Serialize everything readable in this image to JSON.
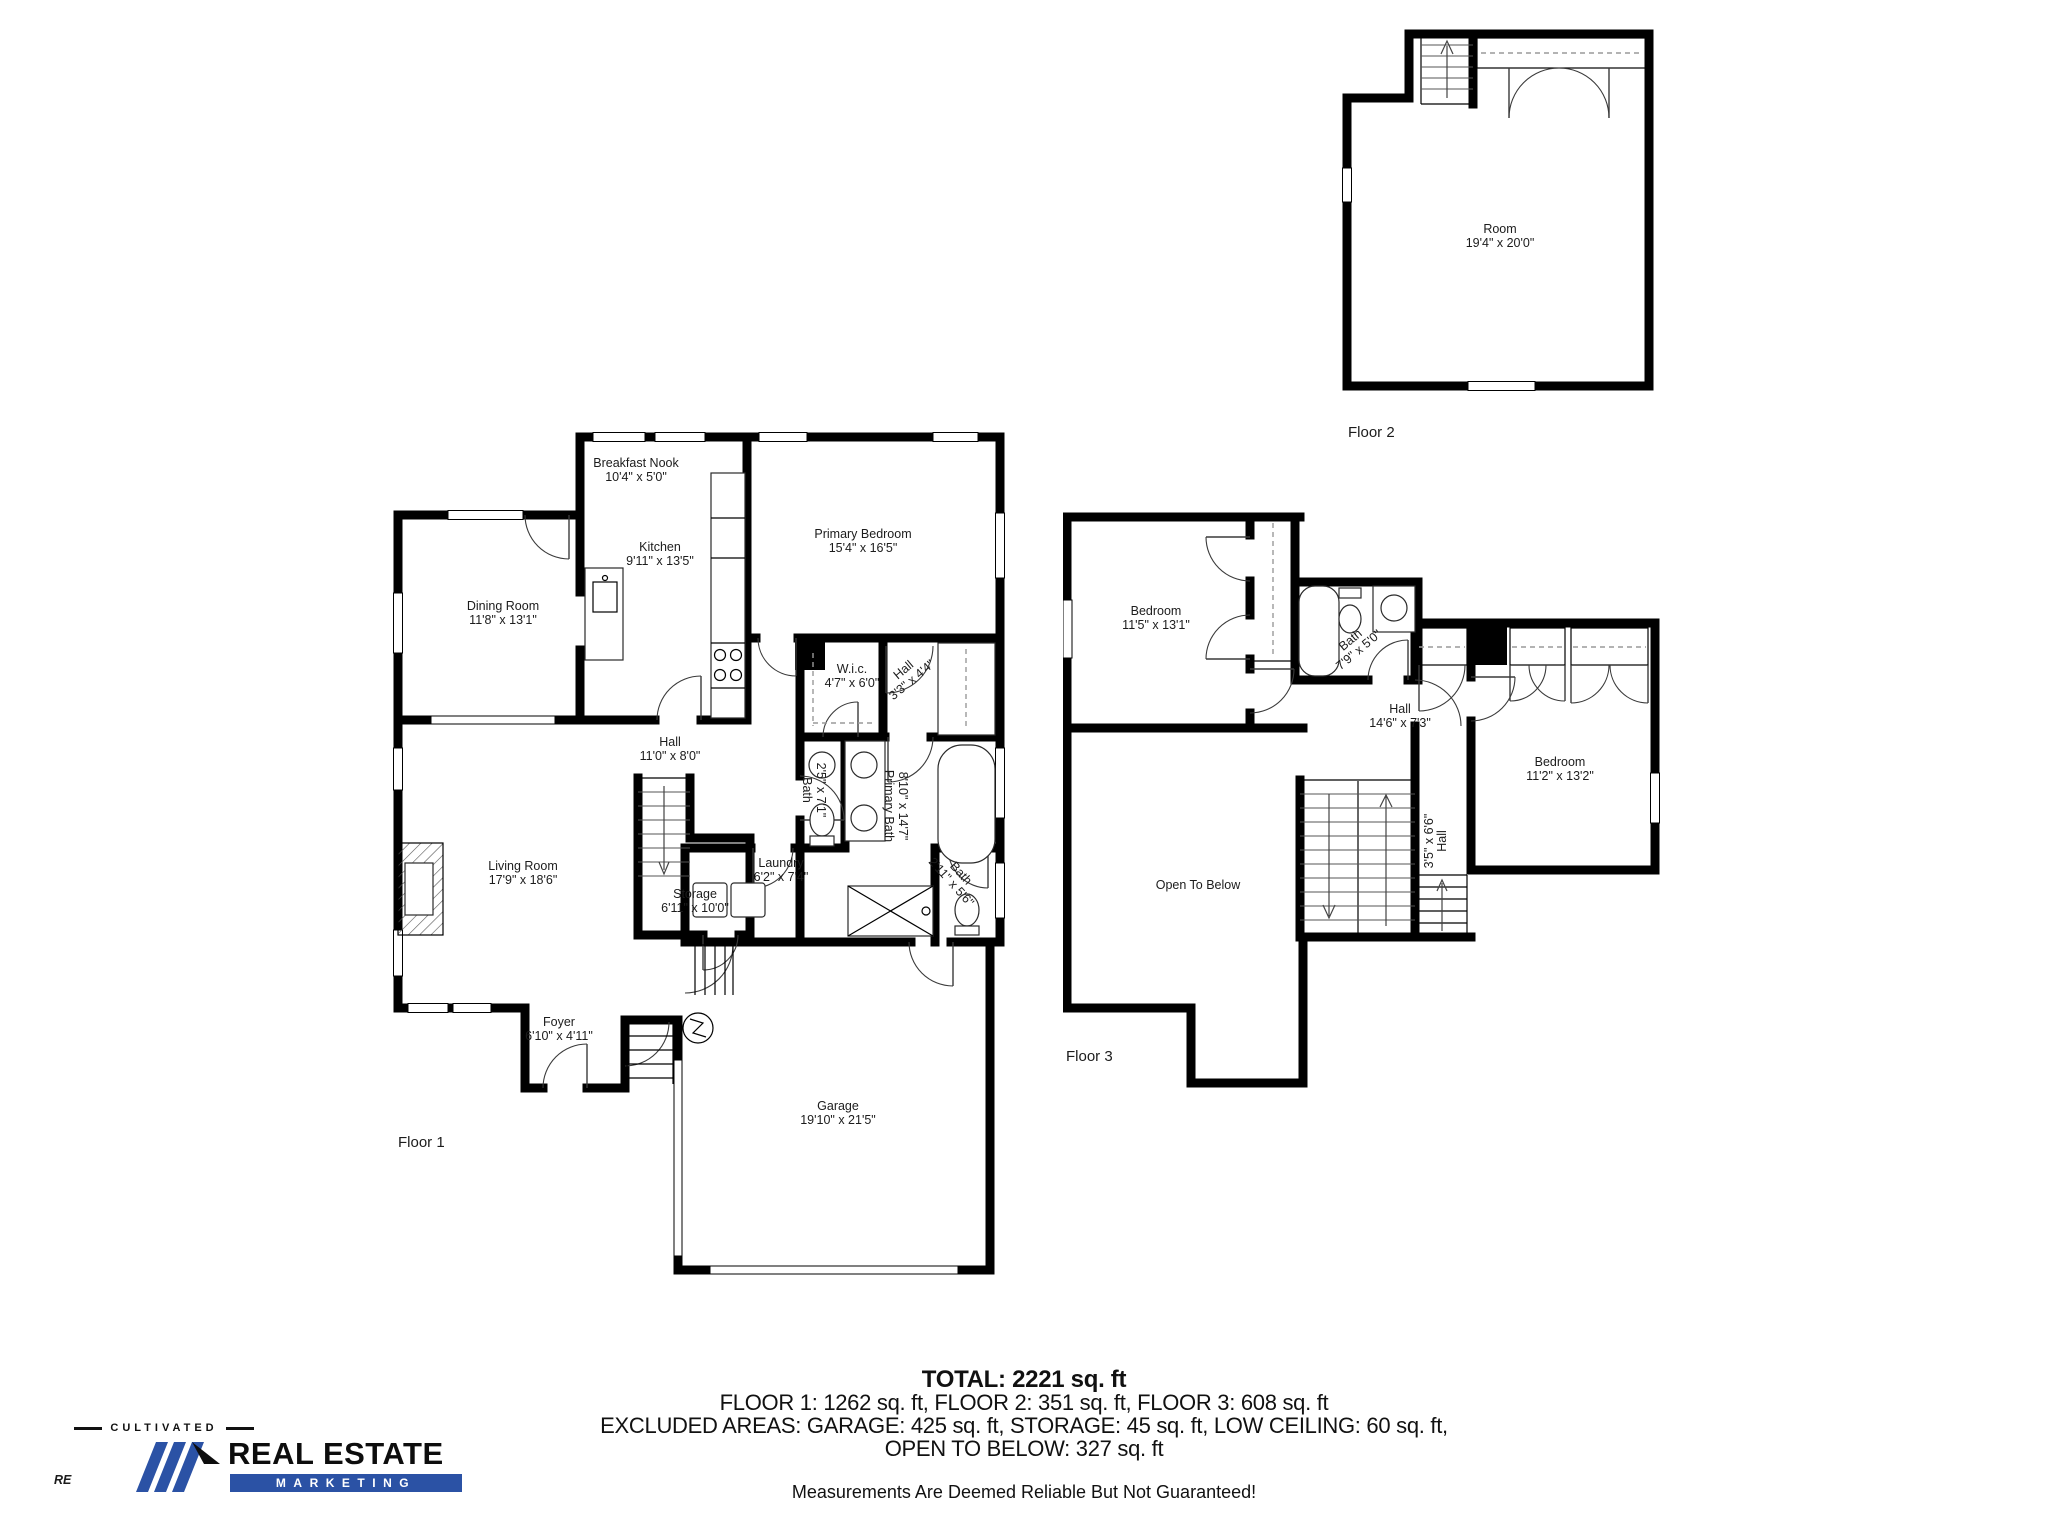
{
  "colors": {
    "wall": "#000000",
    "accent": "#2b52a5",
    "dash_gray": "#9a9a9a"
  },
  "f1": {
    "label": "Floor 1",
    "breakfast": {
      "name": "Breakfast Nook",
      "dims": "10'4\" x 5'0\""
    },
    "kitchen": {
      "name": "Kitchen",
      "dims": "9'11\" x 13'5\""
    },
    "primary_bedroom": {
      "name": "Primary Bedroom",
      "dims": "15'4\" x 16'5\""
    },
    "dining": {
      "name": "Dining Room",
      "dims": "11'8\" x 13'1\""
    },
    "hall": {
      "name": "Hall",
      "dims": "11'0\" x 8'0\""
    },
    "wic": {
      "name": "W.i.c.",
      "dims": "4'7\" x 6'0\""
    },
    "hall_small": {
      "name": "Hall",
      "dims": "3'3\" x 4'4\""
    },
    "bath_small": {
      "name": "Bath",
      "dims": "2'5\" x 7'1\""
    },
    "primary_bath": {
      "name": "Primary Bath",
      "dims": "8'10\" x 14'7\""
    },
    "bath_half": {
      "name": "Bath",
      "dims": "2'11\" x 5'6\""
    },
    "laundry": {
      "name": "Laundry",
      "dims": "6'2\" x 7'4\""
    },
    "storage": {
      "name": "Storage",
      "dims": "6'11\" x 10'0\""
    },
    "living": {
      "name": "Living Room",
      "dims": "17'9\" x 18'6\""
    },
    "foyer": {
      "name": "Foyer",
      "dims": "6'10\" x 4'11\""
    },
    "garage": {
      "name": "Garage",
      "dims": "19'10\" x 21'5\""
    }
  },
  "f2": {
    "label": "Floor 2",
    "room": {
      "name": "Room",
      "dims": "19'4\" x 20'0\""
    }
  },
  "f3": {
    "label": "Floor 3",
    "bedroom1": {
      "name": "Bedroom",
      "dims": "11'5\" x 13'1\""
    },
    "bath": {
      "name": "Bath",
      "dims": "7'9\" x 5'0\""
    },
    "hall": {
      "name": "Hall",
      "dims": "14'6\" x 7'3\""
    },
    "bedroom2": {
      "name": "Bedroom",
      "dims": "11'2\" x 13'2\""
    },
    "hall_small": {
      "name": "Hall",
      "dims": "3'5\" x 6'6\""
    },
    "open_below": {
      "name": "Open To Below"
    }
  },
  "summary": {
    "total": "TOTAL: 2221 sq. ft",
    "floors_line": "FLOOR 1: 1262 sq. ft, FLOOR 2: 351 sq. ft, FLOOR 3: 608 sq. ft",
    "excluded_line1": "EXCLUDED AREAS: GARAGE: 425 sq. ft, STORAGE: 45 sq. ft, LOW CEILING: 60 sq. ft,",
    "excluded_line2": "OPEN TO BELOW: 327 sq. ft",
    "disclaimer": "Measurements Are Deemed Reliable But Not Guaranteed!"
  },
  "logo": {
    "tagline": "CULTIVATED",
    "mark": "RE",
    "name": "REAL ESTATE",
    "band": "MARKETING"
  }
}
